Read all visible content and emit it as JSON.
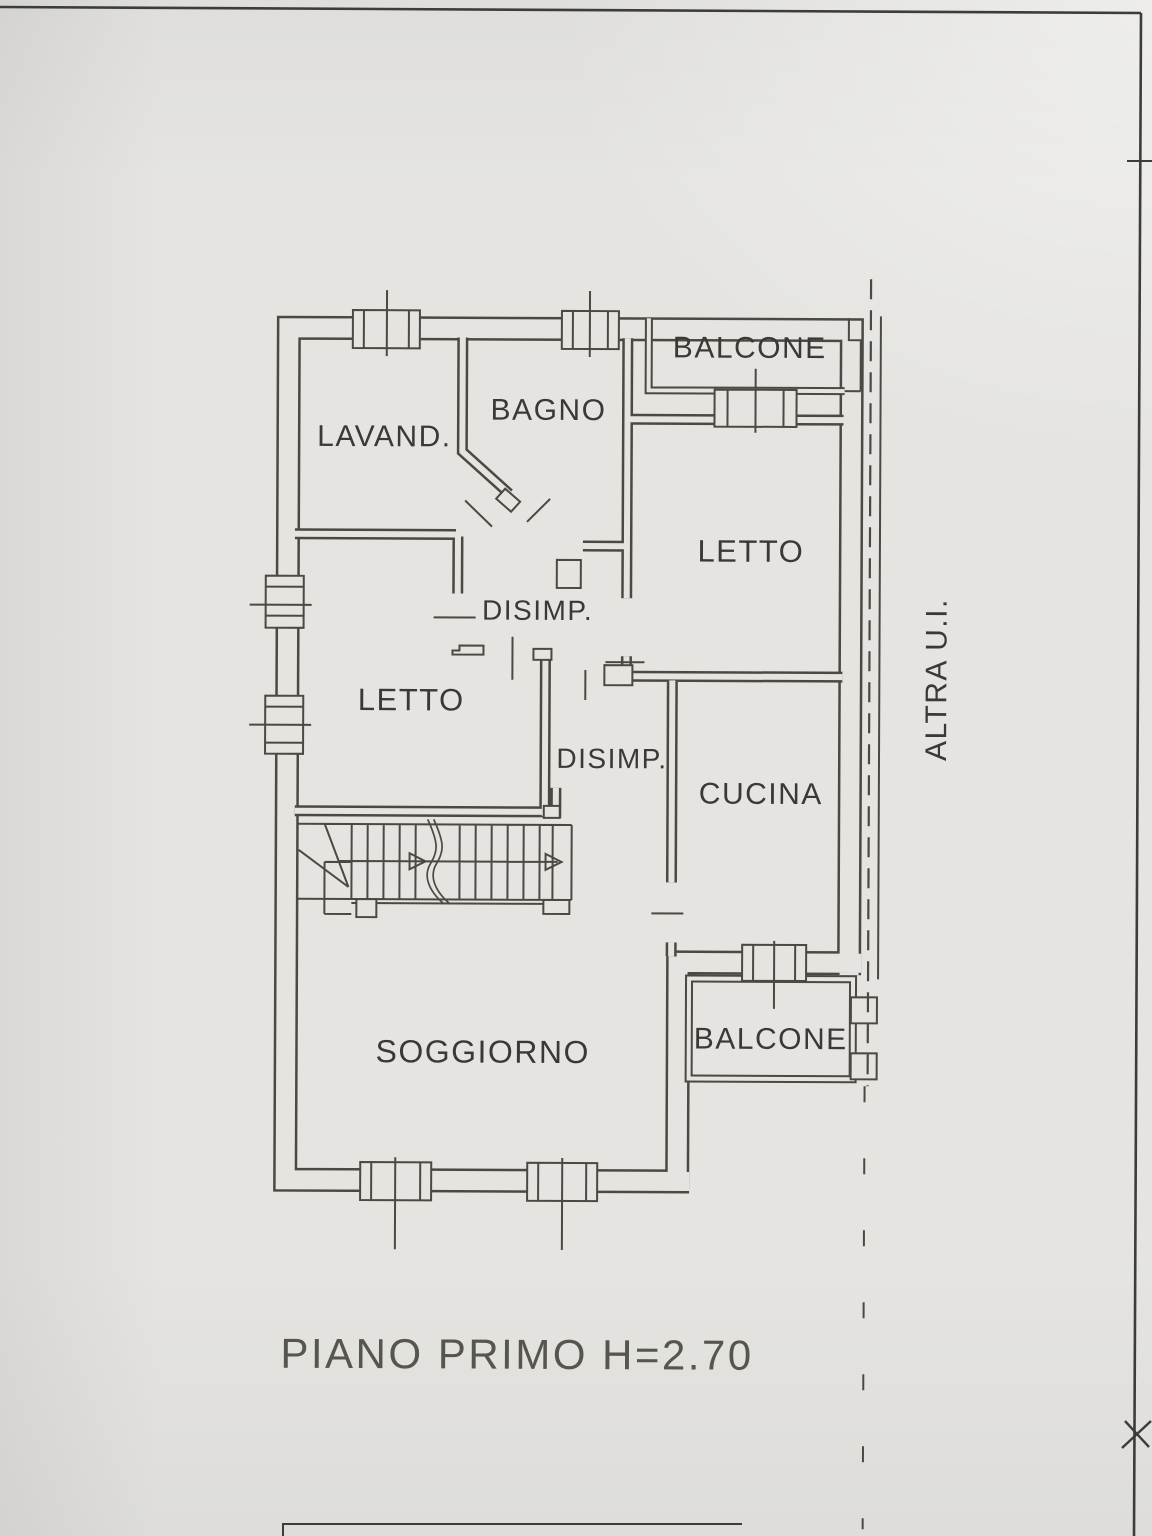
{
  "document": {
    "caption": "PIANO PRIMO H=2.70",
    "adjacent_unit_label": "ALTRA U.I.",
    "rooms": {
      "balcone_top": "BALCONE",
      "lavanderia": "LAVAND.",
      "bagno": "BAGNO",
      "letto_right": "LETTO",
      "disimpegno_upper": "DISIMP.",
      "letto_left": "LETTO",
      "disimpegno_lower": "DISIMP.",
      "cucina": "CUCINA",
      "soggiorno": "SOGGIORNO",
      "balcone_bottom": "BALCONE"
    },
    "colors": {
      "paper": "#e5e4e1",
      "ink": "#4a4944",
      "text": "#3a3936",
      "caption": "#56554f"
    }
  }
}
